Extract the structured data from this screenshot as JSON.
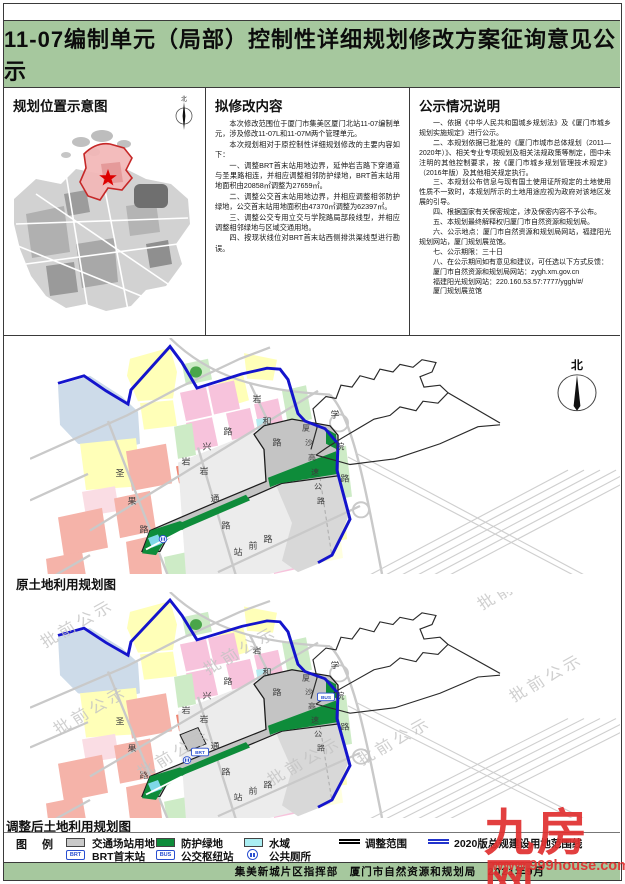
{
  "title": "11-07编制单元（局部）控制性详细规划修改方案征询意见公示",
  "panels": {
    "location": {
      "heading": "规划位置示意图",
      "north_label": "北"
    },
    "modification": {
      "heading": "拟修改内容",
      "paragraphs": [
        "本次修改范围位于厦门市集美区厦门北站11-07编制单元，涉及修改11-07L和11-07M两个管理单元。",
        "本次规划相对于原控制性详细规划修改的主要内容如下：",
        "一、调整BRT首末站用地边界，延伸岩吉路下穿通道与圣果路相连，并相应调整相邻防护绿地，BRT首末站用地面积由20858㎡调整为27659㎡。",
        "二、调整公交首末站用地边界，并相应调整相邻防护绿地，公交首末站用地面积由47370㎡调整为62397㎡。",
        "三、调整公交专用立交与学院路局部段线型，并相应调整相邻绿地与区域交通用地。",
        "四、按现状线位对BRT首末站西侧排洪渠线型进行勘误。"
      ]
    },
    "notice": {
      "heading": "公示情况说明",
      "paragraphs": [
        "一、依据《中华人民共和国城乡规划法》及《厦门市城乡规划实施规定》进行公示。",
        "二、本规划依据已批准的《厦门市城市总体规划（2011—2020年）》、相关专业专项规划及相关法规政策等制定，图中未注明的其他控制要求，按《厦门市城乡规划管理技术规定》（2016年版）及其他相关规定执行。",
        "三、本规划公布信息与现有国土使用证所规定的土地使用性质不一致时，本规划所示的土地用途应视为政府对该地区发展的引导。",
        "四、根据国家有关保密规定，涉及保密内容不予公布。",
        "五、本规划最终解释权归厦门市自然资源和规划局。",
        "六、公示地点：厦门市自然资源和规划局网站，福建阳光规划网站，厦门规划展览馆。",
        "七、公示期限：三十日",
        "八、在公示期间如有意见和建议，可任选以下方式反馈：",
        "厦门市自然资源和规划局网站：zygh.xm.gov.cn",
        "福建阳光规划网站：220.160.53.57:7777/yggh/#/",
        "厦门规划展览馆"
      ]
    }
  },
  "maps": {
    "map1_label": "原土地利用规划图",
    "map2_label": "调整后土地利用规划图",
    "north_label": "北",
    "road_labels": [
      "圣果路",
      "岩兴路",
      "岩通路",
      "岩和路",
      "站前路",
      "厦沙高速公路",
      "学院路"
    ],
    "badges": {
      "brt": "BRT",
      "bus": "BUS"
    },
    "watermark_text": "批前公示"
  },
  "legend": {
    "heading": "图　例",
    "items": [
      {
        "label": "交通场站用地",
        "swatch": "gray"
      },
      {
        "label": "防护绿地",
        "swatch": "green"
      },
      {
        "label": "水域",
        "swatch": "cyan"
      },
      {
        "label": "调整范围",
        "swatch": "black-line"
      },
      {
        "label": "2020版总规建设用地范围线",
        "swatch": "blue-line"
      },
      {
        "label": "BRT首末站",
        "swatch": "brt-badge"
      },
      {
        "label": "公交枢纽站",
        "swatch": "bus-badge"
      },
      {
        "label": "公共厕所",
        "swatch": "wc-icon"
      }
    ]
  },
  "footer": {
    "text": "集美新城片区指挥部　厦门市自然资源和规划局　2021年9月"
  },
  "site_watermark": {
    "name": "九房网",
    "url": "www.999house.com"
  },
  "colors": {
    "title_bar_green": "#a6c89e",
    "protective_green": "#0e8c3a",
    "water_cyan": "#aaeef2",
    "transport_station_gray": "#c9c9c9",
    "adjust_range_line": "#000000",
    "master_plan_line_blue": "#2233cc",
    "boundary_blue": "#1414cc",
    "highlight_red": "#cc2222",
    "watermark_red": "#e03131"
  }
}
